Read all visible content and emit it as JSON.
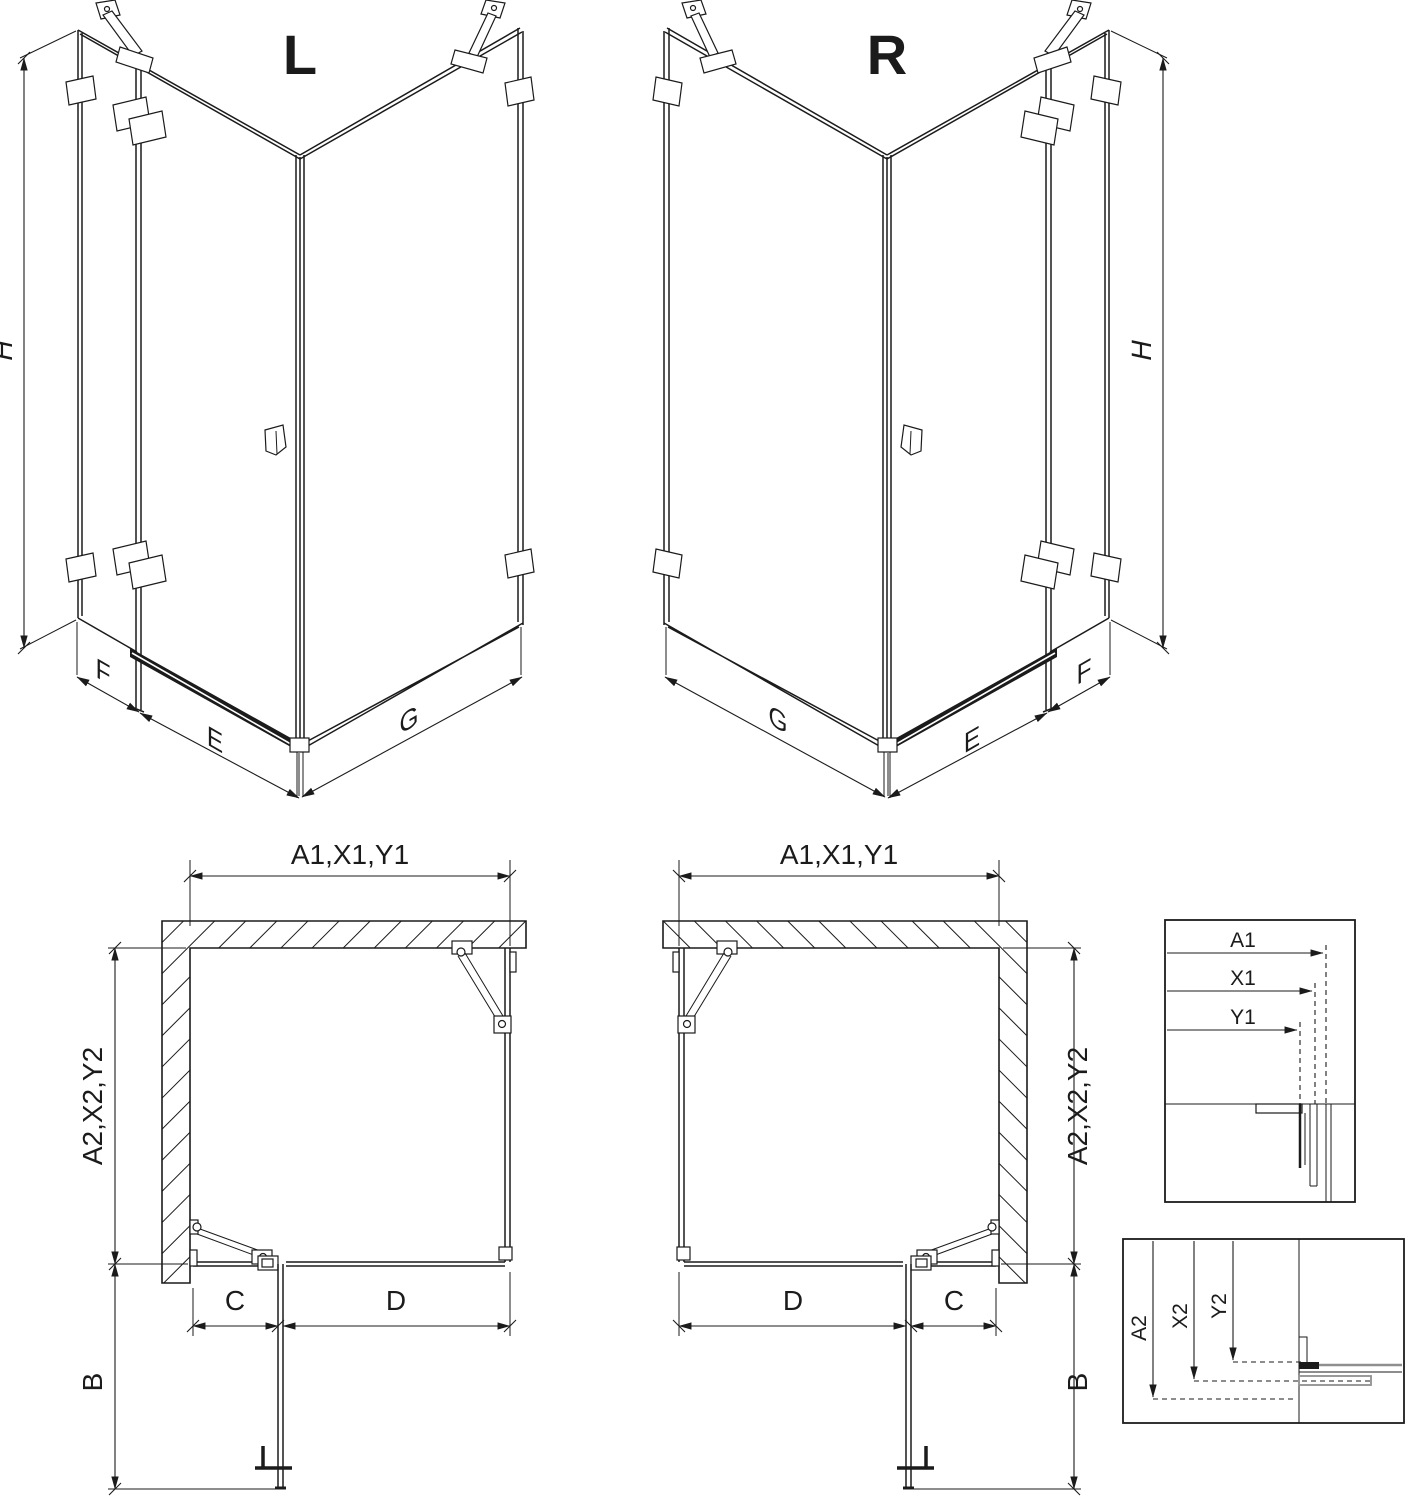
{
  "views": {
    "iso_left": {
      "label": "L",
      "dim_h": "H",
      "dim_f": "F",
      "dim_e": "E",
      "dim_g": "G"
    },
    "iso_right": {
      "label": "R",
      "dim_h": "H",
      "dim_f": "F",
      "dim_e": "E",
      "dim_g": "G"
    },
    "plan_left": {
      "dim_width": "A1,X1,Y1",
      "dim_depth": "A2,X2,Y2",
      "dim_b": "B",
      "dim_c": "C",
      "dim_d": "D"
    },
    "plan_right": {
      "dim_width": "A1,X1,Y1",
      "dim_depth": "A2,X2,Y2",
      "dim_b": "B",
      "dim_c": "C",
      "dim_d": "D"
    }
  },
  "details": {
    "top": {
      "a1": "A1",
      "x1": "X1",
      "y1": "Y1"
    },
    "bottom": {
      "a2": "A2",
      "x2": "X2",
      "y2": "Y2"
    }
  },
  "colors": {
    "line": "#1b1b1b",
    "gray": "#8f8f8f",
    "background": "#ffffff"
  }
}
